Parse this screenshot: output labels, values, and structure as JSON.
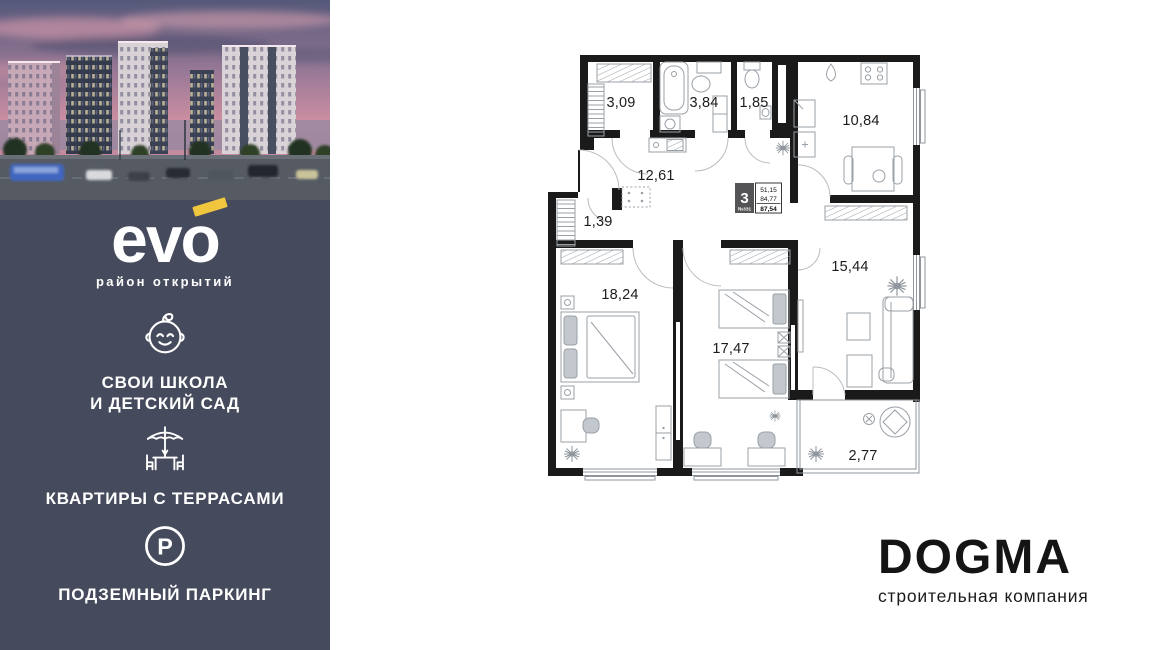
{
  "sidebar": {
    "brand": "evo",
    "tagline": "район открытий",
    "features": [
      {
        "icon": "baby-icon",
        "label": "СВОИ ШКОЛА\nИ ДЕТСКИЙ САД"
      },
      {
        "icon": "terrace-icon",
        "label": "КВАРТИРЫ С ТЕРРАСАМИ"
      },
      {
        "icon": "parking-icon",
        "label": "ПОДЗЕМНЫЙ ПАРКИНГ"
      }
    ]
  },
  "plan": {
    "unit": {
      "rooms_count": "3",
      "number": "№331",
      "living_area": "51,15",
      "total_area": "84,77",
      "area_with_terrace": "87,54"
    },
    "rooms": {
      "wardrobe": "3,09",
      "bathroom": "3,84",
      "wc": "1,85",
      "kitchen": "10,84",
      "hallway": "12,61",
      "closet": "1,39",
      "bedroom": "18,24",
      "kids_room": "17,47",
      "living_room": "15,44",
      "terrace": "2,77"
    }
  },
  "developer": {
    "name": "DOGMA",
    "subtitle": "строительная компания"
  },
  "colors": {
    "sidebar_bg": "#454a5c",
    "accent_yellow": "#f0c63f",
    "wall": "#1a1a1a"
  }
}
